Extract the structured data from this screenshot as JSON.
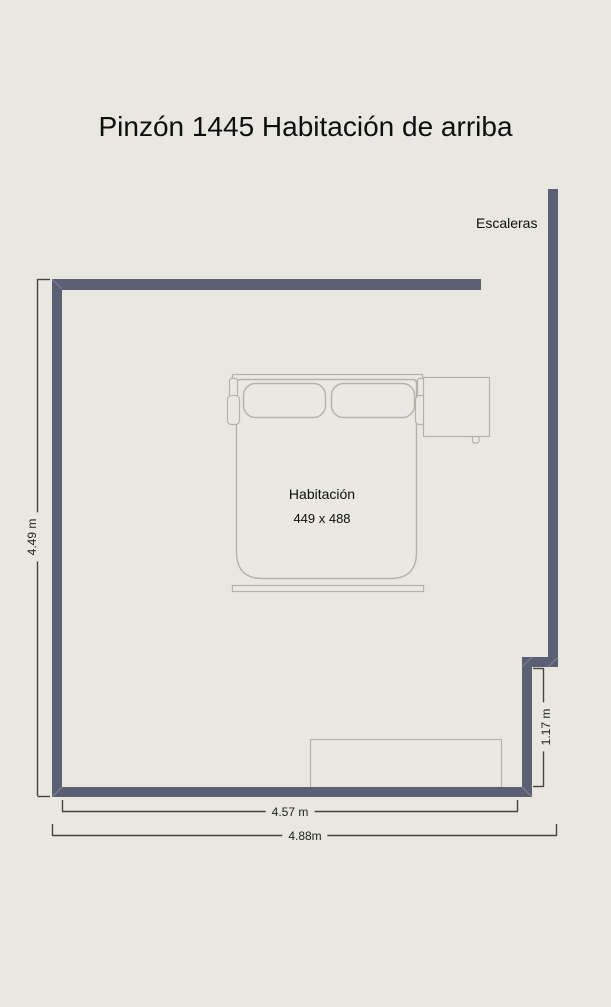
{
  "title": "Pinzón 1445 Habitación de arriba",
  "labels": {
    "stairs": "Escaleras",
    "room_name": "Habitación",
    "room_size": "449 x 488"
  },
  "dimensions": {
    "left_height": "4.49 m",
    "right_step": "1.17 m",
    "bottom_inner": "4.57 m",
    "bottom_outer": "4.88m"
  },
  "theme": {
    "background_color": "#e8e7e0",
    "wall_color": "#5a5f73",
    "wall_seam_color": "#7e8295",
    "furniture_line_color": "#b3b3ab",
    "dimension_line_color": "#45453e",
    "text_color": "#0e0e0e"
  }
}
